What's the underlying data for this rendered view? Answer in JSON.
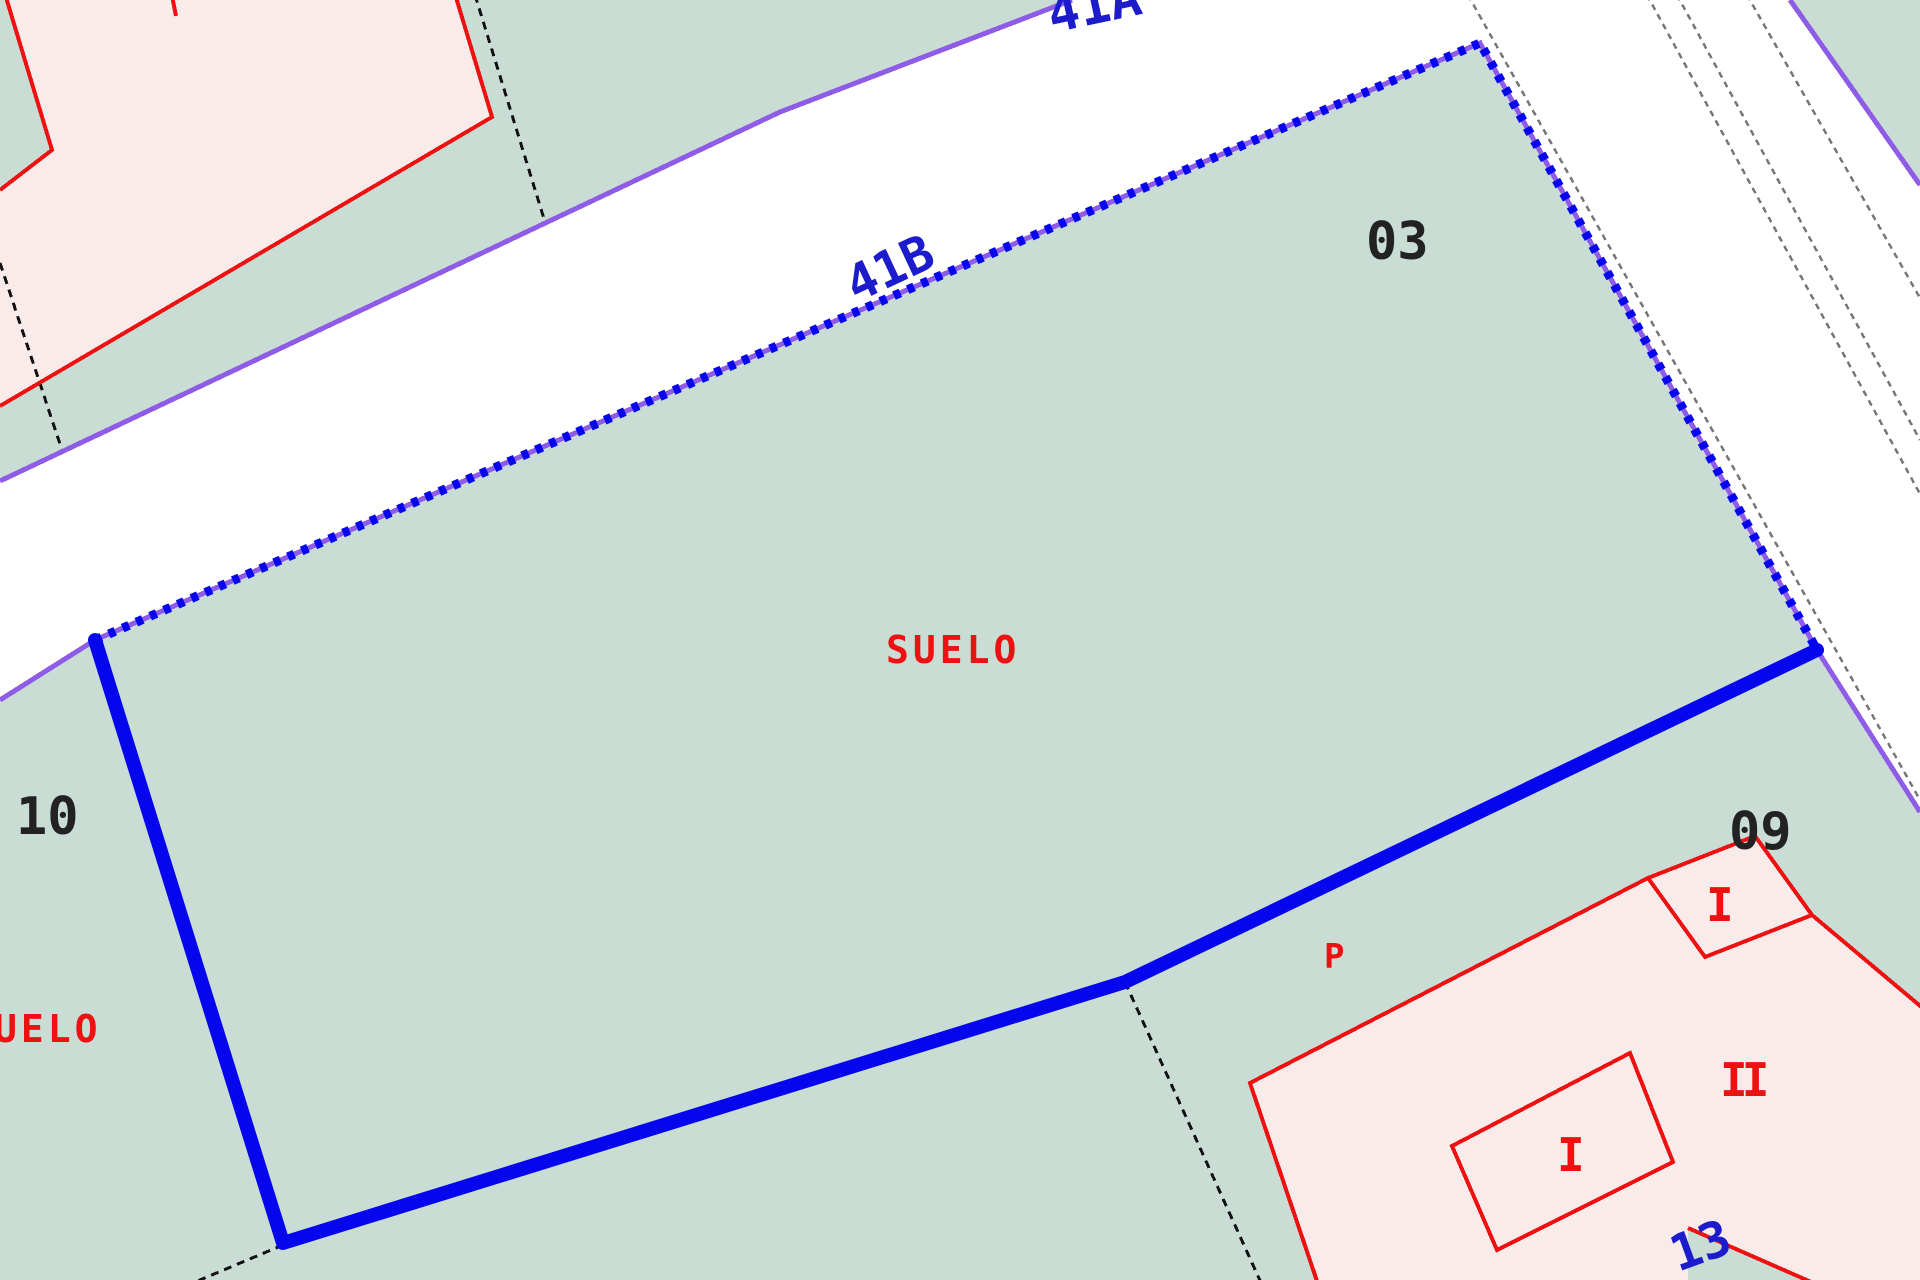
{
  "map": {
    "labels": {
      "street_a": "41A",
      "street_b": "41B",
      "parcel_03": "03",
      "parcel_10": "10",
      "parcel_09": "09",
      "suelo_center": "SUELO",
      "suelo_left_partial": "UELO",
      "patio_mark": "P",
      "floors_one_top": "I",
      "floors_two": "II",
      "floors_one_inner": "I",
      "portal_13": "13"
    },
    "colors": {
      "parcel_fill": "#c9ddd5",
      "road_fill": "#ffffff",
      "building_fill": "#f9ebe9",
      "building_inner_fill": "#fdf5f3",
      "building_outline": "#ee1111",
      "label_red": "#ee1111",
      "label_black": "#222222",
      "label_blue": "#1c1ccd",
      "selection_blue": "#0505ee",
      "boundary_purple": "#8f5ce8",
      "boundary_gray": "#777777",
      "boundary_black": "#111111"
    }
  }
}
